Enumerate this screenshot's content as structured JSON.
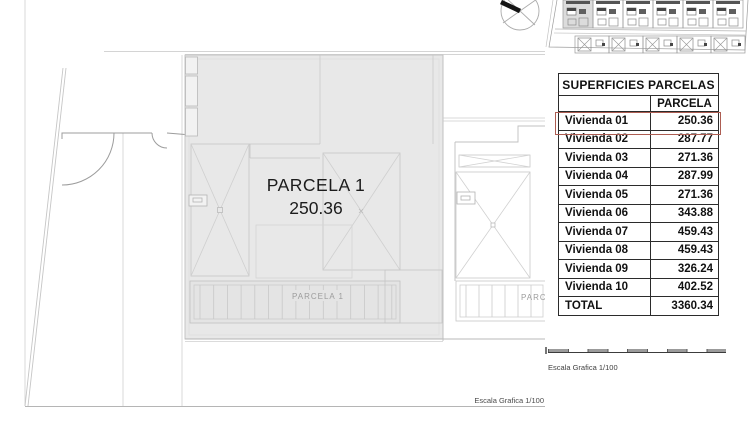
{
  "main_plan": {
    "parcel_title": "PARCELA 1",
    "parcel_area": "250.36",
    "pergola_label": "PARCELA 1",
    "adjacent_pergola_label": "PARC",
    "scale_note": "Escala Grafica 1/100"
  },
  "panel": {
    "table": {
      "title": "SUPERFICIES PARCELAS",
      "column_header": "PARCELA",
      "rows": [
        {
          "label": "Vivienda 01",
          "value": "250.36"
        },
        {
          "label": "Vivienda 02",
          "value": "287.77"
        },
        {
          "label": "Vivienda 03",
          "value": "271.36"
        },
        {
          "label": "Vivienda 04",
          "value": "287.99"
        },
        {
          "label": "Vivienda 05",
          "value": "271.36"
        },
        {
          "label": "Vivienda 06",
          "value": "343.88"
        },
        {
          "label": "Vivienda 07",
          "value": "459.43"
        },
        {
          "label": "Vivienda 08",
          "value": "459.43"
        },
        {
          "label": "Vivienda 09",
          "value": "326.24"
        },
        {
          "label": "Vivienda 10",
          "value": "402.52"
        },
        {
          "label": "TOTAL",
          "value": "3360.34"
        }
      ],
      "highlighted_row": "Vivienda 01"
    },
    "scale_note": "Escala Grafica 1/100"
  },
  "colors": {
    "highlight_border": "#ad5d52",
    "parcel_fill": "#e8e8e8",
    "drawing_line": "#c3c3c3",
    "label_gray": "#9c9c9c"
  }
}
